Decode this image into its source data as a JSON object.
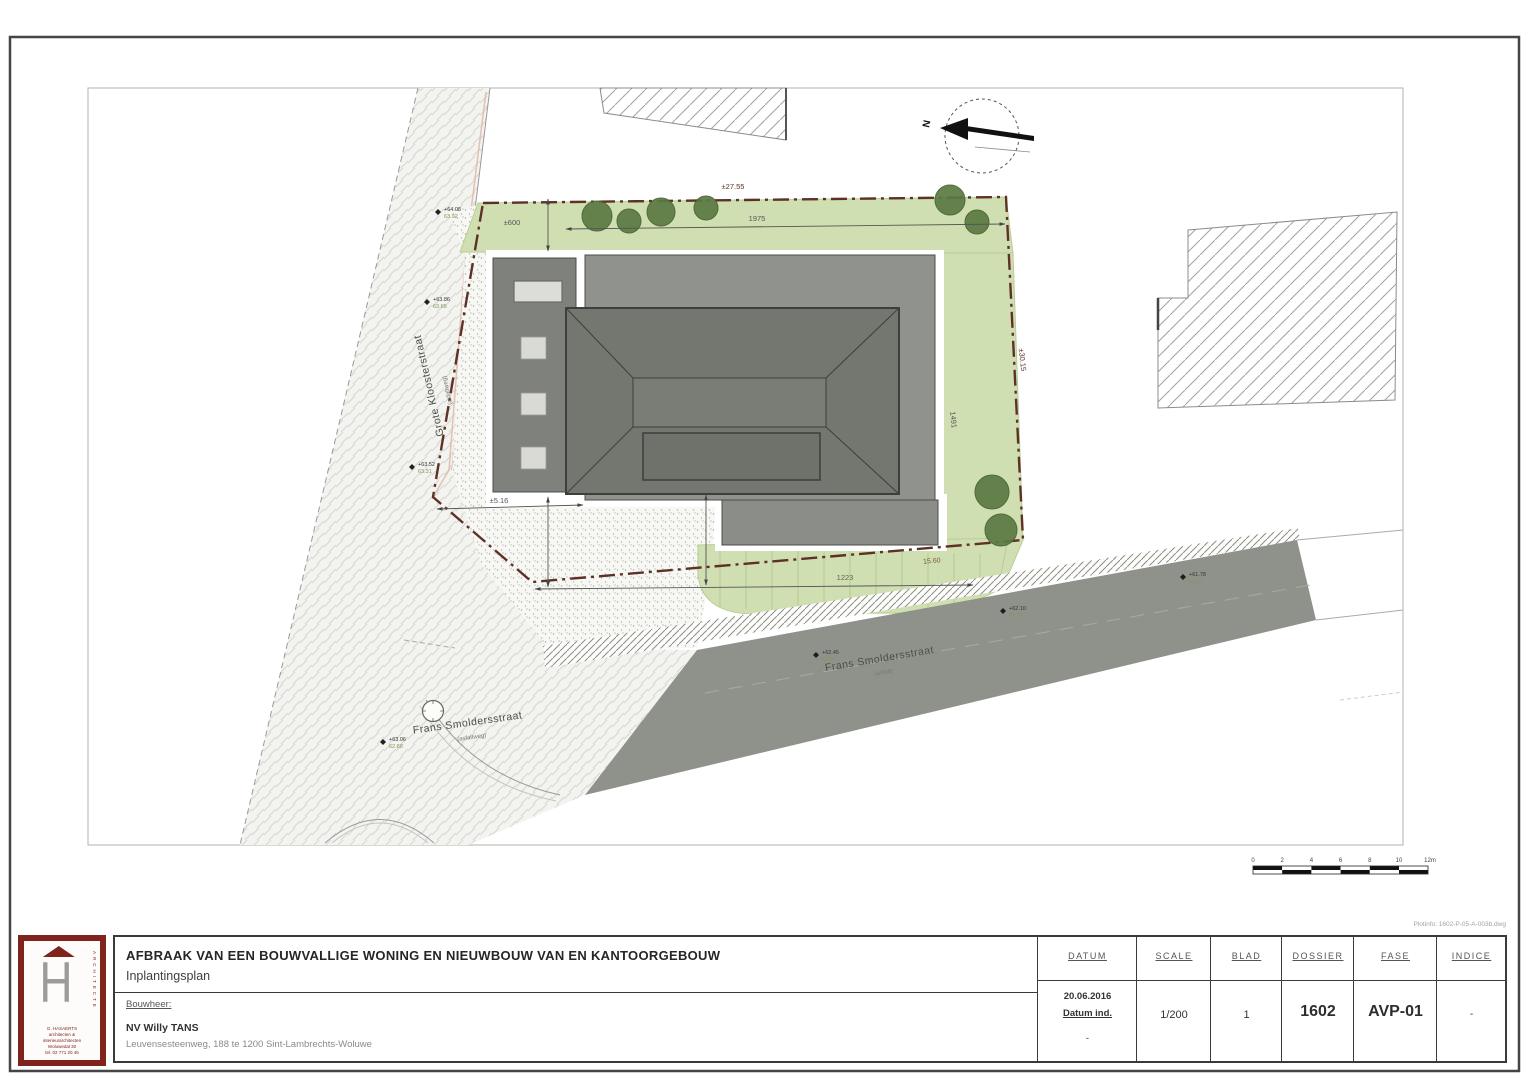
{
  "title_block": {
    "project_title": "AFBRAAK VAN EEN BOUWVALLIGE WONING EN NIEUWBOUW VAN EN KANTOORGEBOUW",
    "drawing_name": "Inplantingsplan",
    "client_label": "Bouwheer:",
    "client_name": "NV Willy TANS",
    "client_address": "Leuvensesteenweg, 188 te 1200 Sint-Lambrechts-Woluwe",
    "plot_ref": "Plotinfo: 1602-P-05-A-003b.dwg",
    "columns": [
      {
        "label": "DATUM",
        "line1": "20.06.2016",
        "line2": "Datum ind.",
        "line3": "-"
      },
      {
        "label": "SCALE",
        "value": "1/200"
      },
      {
        "label": "BLAD",
        "value": "1"
      },
      {
        "label": "DOSSIER",
        "value": "1602"
      },
      {
        "label": "FASE",
        "value": "AVP-01"
      },
      {
        "label": "INDICE",
        "value": "-"
      }
    ]
  },
  "logo": {
    "letter": "H",
    "side_text": "ARCHITECTE",
    "lines": [
      "G. HASAERTS",
      "architecten &",
      "interieurarchitecten",
      "Woluwedal 30",
      "tel. 02 771 20 45"
    ]
  },
  "plan": {
    "streets": {
      "left_name": "Grote Kloosterstraat",
      "left_sub": "(asfaltweg)",
      "mid_name": "Frans Smoldersstraat",
      "mid_sub": "(asfaltweg)",
      "road_name": "Frans Smoldersstraat",
      "road_sub": "(asfalt)"
    },
    "north_label": "N",
    "dims": {
      "boundary_top": "±27.55",
      "lawn_width": "1975",
      "setback_top": "±600",
      "boundary_right": "±30.15",
      "right_strip": "1491",
      "bottom_width": "1223",
      "boundary_bottom": "15.60",
      "setback_left": "±5.16"
    },
    "scalebar": [
      "0",
      "2",
      "4",
      "6",
      "8",
      "10",
      "12m"
    ],
    "elevations": [
      {
        "a": "+64.08",
        "b": "63.92"
      },
      {
        "a": "+63.86",
        "b": "63.65"
      },
      {
        "a": "+63.52",
        "b": "63.31"
      },
      {
        "a": "+63.06",
        "b": "62.88"
      },
      {
        "a": "+62.45",
        "b": "62.31"
      },
      {
        "a": "+62.10",
        "b": "61.95"
      },
      {
        "a": "+61.78",
        "b": "61.60"
      }
    ]
  }
}
